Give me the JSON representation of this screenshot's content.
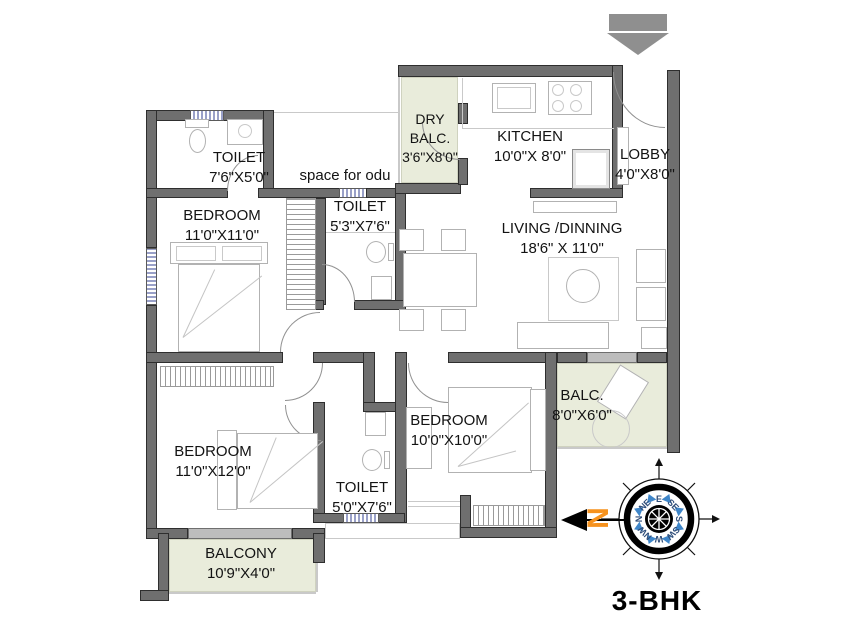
{
  "annotations": {
    "odu": "space for odu",
    "plan_title": "3-BHK",
    "north": "N"
  },
  "rooms": {
    "toilet1": {
      "name": "TOILET",
      "dims": "7'6\"X5'0\""
    },
    "bedroom1": {
      "name": "BEDROOM",
      "dims": "11'0\"X11'0\""
    },
    "toilet2": {
      "name": "TOILET",
      "dims": "5'3\"X7'6\""
    },
    "dry_balcony": {
      "line1": "DRY",
      "line2": "BALC.",
      "dims": "3'6\"X8'0\""
    },
    "kitchen": {
      "name": "KITCHEN",
      "dims": "10'0\"X 8'0\""
    },
    "lobby": {
      "name": "LOBBY",
      "dims": "4'0\"X8'0\""
    },
    "living": {
      "name": "LIVING /DINNING",
      "dims": "18'6\" X 11'0\""
    },
    "balcony_right": {
      "name": "BALC.",
      "dims": "8'0\"X6'0\""
    },
    "bedroom3": {
      "name": "BEDROOM",
      "dims": "10'0\"X10'0\""
    },
    "toilet3": {
      "name": "TOILET",
      "dims": "5'0\"X7'6\""
    },
    "bedroom2": {
      "name": "BEDROOM",
      "dims": "11'0\"X12'0\""
    },
    "balcony_bottom": {
      "name": "BALCONY",
      "dims": "10'9\"X4'0\""
    }
  },
  "compass": {
    "e": "E",
    "se": "SE",
    "s": "S",
    "sw": "SW",
    "w": "W",
    "nw": "NW",
    "n": "N",
    "ne": "NE"
  },
  "colors": {
    "wall": "#6f6f6f",
    "balcony_fill": "#e9ecdb",
    "north_orange": "#f6921e",
    "compass_blue": "#3f86c9",
    "marker_gray": "#8f8f8f"
  }
}
